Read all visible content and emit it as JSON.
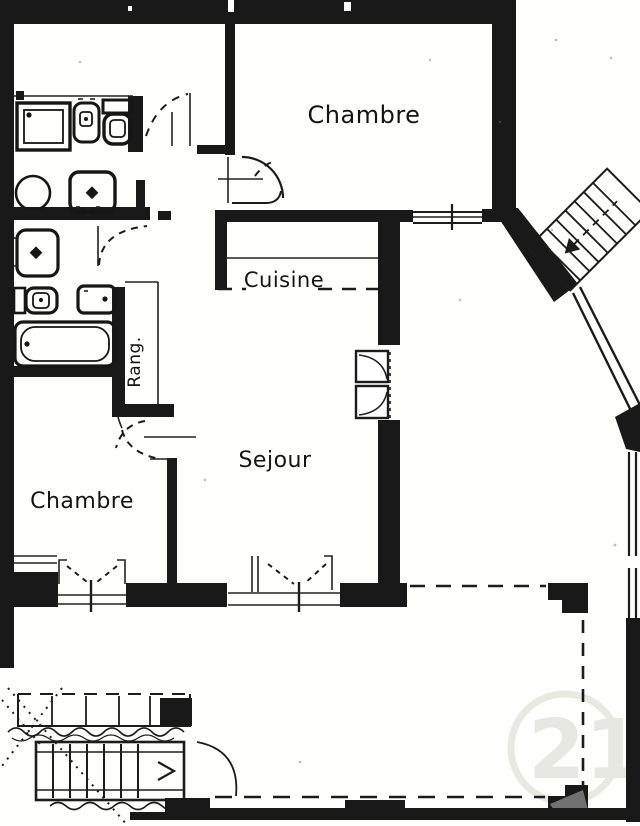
{
  "labels": {
    "bedroom_top": "Chambre",
    "kitchen": "Cuisine",
    "storage": "Rang.",
    "living_room": "Sejour",
    "bedroom_bottom": "Chambre"
  },
  "watermark": {
    "text": "21"
  },
  "colors": {
    "ink": "#1a1a1a",
    "paper": "#fefefc",
    "watermark_gray": "#e8e8e3",
    "smudge_gray": "#8f8f8f"
  }
}
